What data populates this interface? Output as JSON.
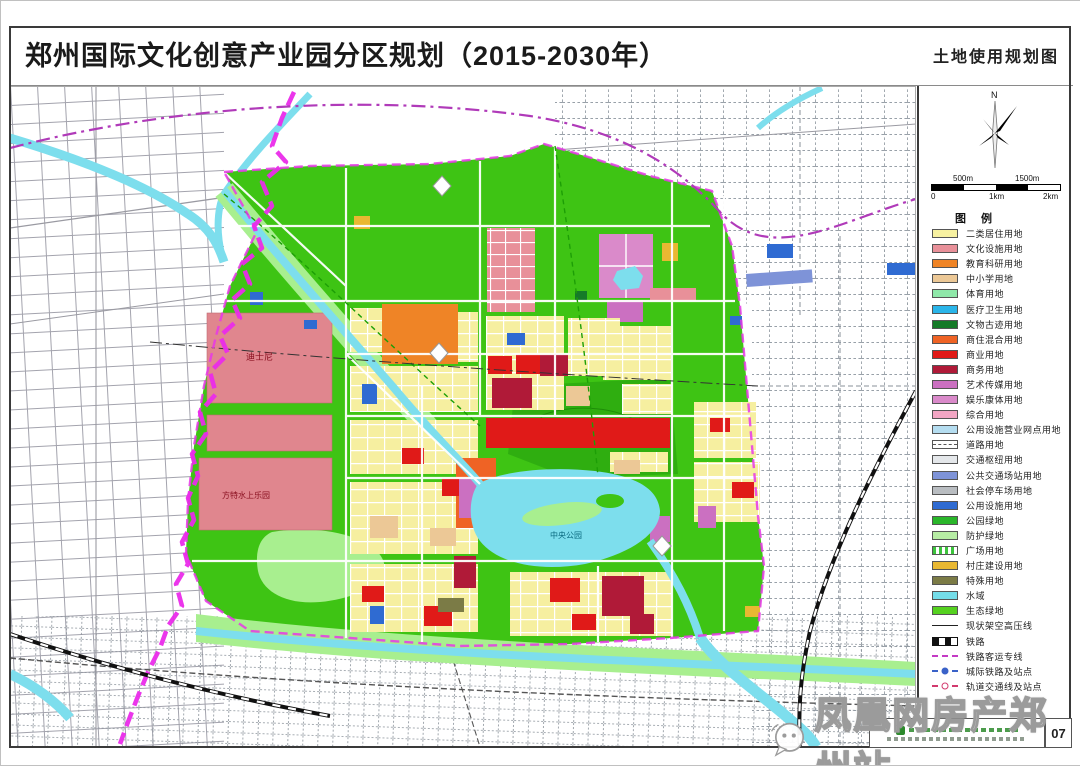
{
  "header": {
    "title": "郑州国际文化创意产业园分区规划（2015-2030年）",
    "subtitle": "土地使用规划图"
  },
  "map": {
    "north_label": "N",
    "labels": {
      "disney": "迪士尼",
      "fantawild": "方特水上乐园",
      "central_park": "中央公园"
    }
  },
  "scale_bar": {
    "top_labels": [
      "500m",
      "1500m"
    ],
    "bottom_labels": [
      "0",
      "1km",
      "2km"
    ]
  },
  "legend": {
    "title": "图 例",
    "items": [
      {
        "label": "二类居住用地",
        "type": "fill",
        "color": "#f7f1a1"
      },
      {
        "label": "文化设施用地",
        "type": "fill",
        "color": "#e89099"
      },
      {
        "label": "教育科研用地",
        "type": "fill",
        "color": "#ef8426"
      },
      {
        "label": "中小学用地",
        "type": "fill",
        "color": "#ecc896"
      },
      {
        "label": "体育用地",
        "type": "fill",
        "color": "#8fe8a9"
      },
      {
        "label": "医疗卫生用地",
        "type": "fill",
        "color": "#2ab5e9"
      },
      {
        "label": "文物古迹用地",
        "type": "fill",
        "color": "#157a28"
      },
      {
        "label": "商住混合用地",
        "type": "fill",
        "color": "#ef6325"
      },
      {
        "label": "商业用地",
        "type": "fill",
        "color": "#e01a18"
      },
      {
        "label": "商务用地",
        "type": "fill",
        "color": "#b01a38"
      },
      {
        "label": "艺术传媒用地",
        "type": "fill",
        "color": "#cb70c1"
      },
      {
        "label": "娱乐康体用地",
        "type": "fill",
        "color": "#da8aca"
      },
      {
        "label": "综合用地",
        "type": "fill",
        "color": "#f3a6c4"
      },
      {
        "label": "公用设施营业网点用地",
        "type": "fill",
        "color": "#b5ddf0"
      },
      {
        "label": "道路用地",
        "type": "road",
        "color": "#ffffff"
      },
      {
        "label": "交通枢纽用地",
        "type": "fill",
        "color": "#e4e7ea"
      },
      {
        "label": "公共交通场站用地",
        "type": "fill",
        "color": "#7e93d8"
      },
      {
        "label": "社会停车场用地",
        "type": "fill",
        "color": "#b9bdc1"
      },
      {
        "label": "公用设施用地",
        "type": "fill",
        "color": "#2f6bd2"
      },
      {
        "label": "公园绿地",
        "type": "fill",
        "color": "#2ab62a"
      },
      {
        "label": "防护绿地",
        "type": "fill",
        "color": "#b7eda4"
      },
      {
        "label": "广场用地",
        "type": "hatch",
        "color": "#3cc43c"
      },
      {
        "label": "村庄建设用地",
        "type": "fill",
        "color": "#e9b832"
      },
      {
        "label": "特殊用地",
        "type": "fill",
        "color": "#7b7b46"
      },
      {
        "label": "水域",
        "type": "fill",
        "color": "#74dde9"
      },
      {
        "label": "生态绿地",
        "type": "fill",
        "color": "#55d11f"
      },
      {
        "label": "现状架空高压线",
        "type": "hvline",
        "color": "#222222"
      },
      {
        "label": "铁路",
        "type": "railway",
        "color": "#111111"
      },
      {
        "label": "铁路客运专线",
        "type": "hsr",
        "color": "#c43ac4"
      },
      {
        "label": "城际铁路及站点",
        "type": "intercity",
        "color": "#3a62c8"
      },
      {
        "label": "轨道交通线及站点",
        "type": "metro",
        "color": "#d23a6e"
      }
    ]
  },
  "watermark": {
    "text": "凤凰网房产郑州站"
  },
  "footer": {
    "page_number": "07"
  }
}
